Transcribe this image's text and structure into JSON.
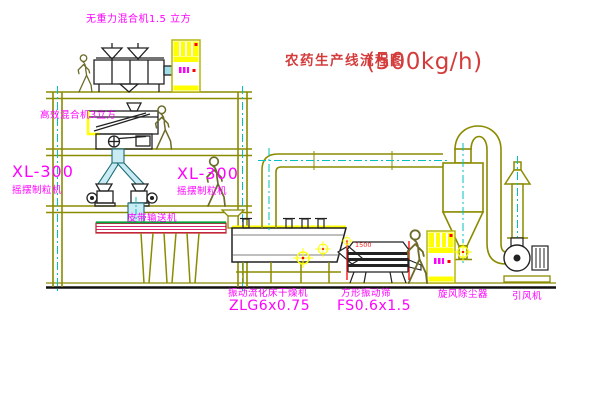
{
  "title": {
    "text": "农药生产线流程图",
    "capacity": "(500kg/h)"
  },
  "equipment": {
    "gravity_mixer": {
      "label": "无重力混合机1.5 立方"
    },
    "high_mixer": {
      "label": "高效混合机3立方"
    },
    "granulator_left": {
      "model": "XL-300",
      "name": "摇摆制粒机"
    },
    "granulator_right": {
      "model": "XL-300",
      "name": "摇摆制粒机"
    },
    "conveyor": {
      "label": "皮带输送机"
    },
    "dryer": {
      "name": "振动流化床干燥机",
      "model": "ZLG6x0.75"
    },
    "screen": {
      "name": "方形振动筛",
      "model": "FS0.6x1.5",
      "dimension": "1500"
    },
    "cyclone": {
      "label": "旋风除尘器"
    },
    "fan": {
      "label": "引风机"
    }
  },
  "colors": {
    "label_text": "#ff00ff",
    "title_text": "#d43c3c",
    "structure_line": "#8b8b00",
    "machine_line": "#222222",
    "centerline": "#00c2c2",
    "highlight": "#ffff00",
    "accent_red": "#ff0000",
    "chute_fill": "#c9ecf4",
    "conveyor_hatch": "#d42a6e",
    "deck_green": "#00a23c"
  }
}
